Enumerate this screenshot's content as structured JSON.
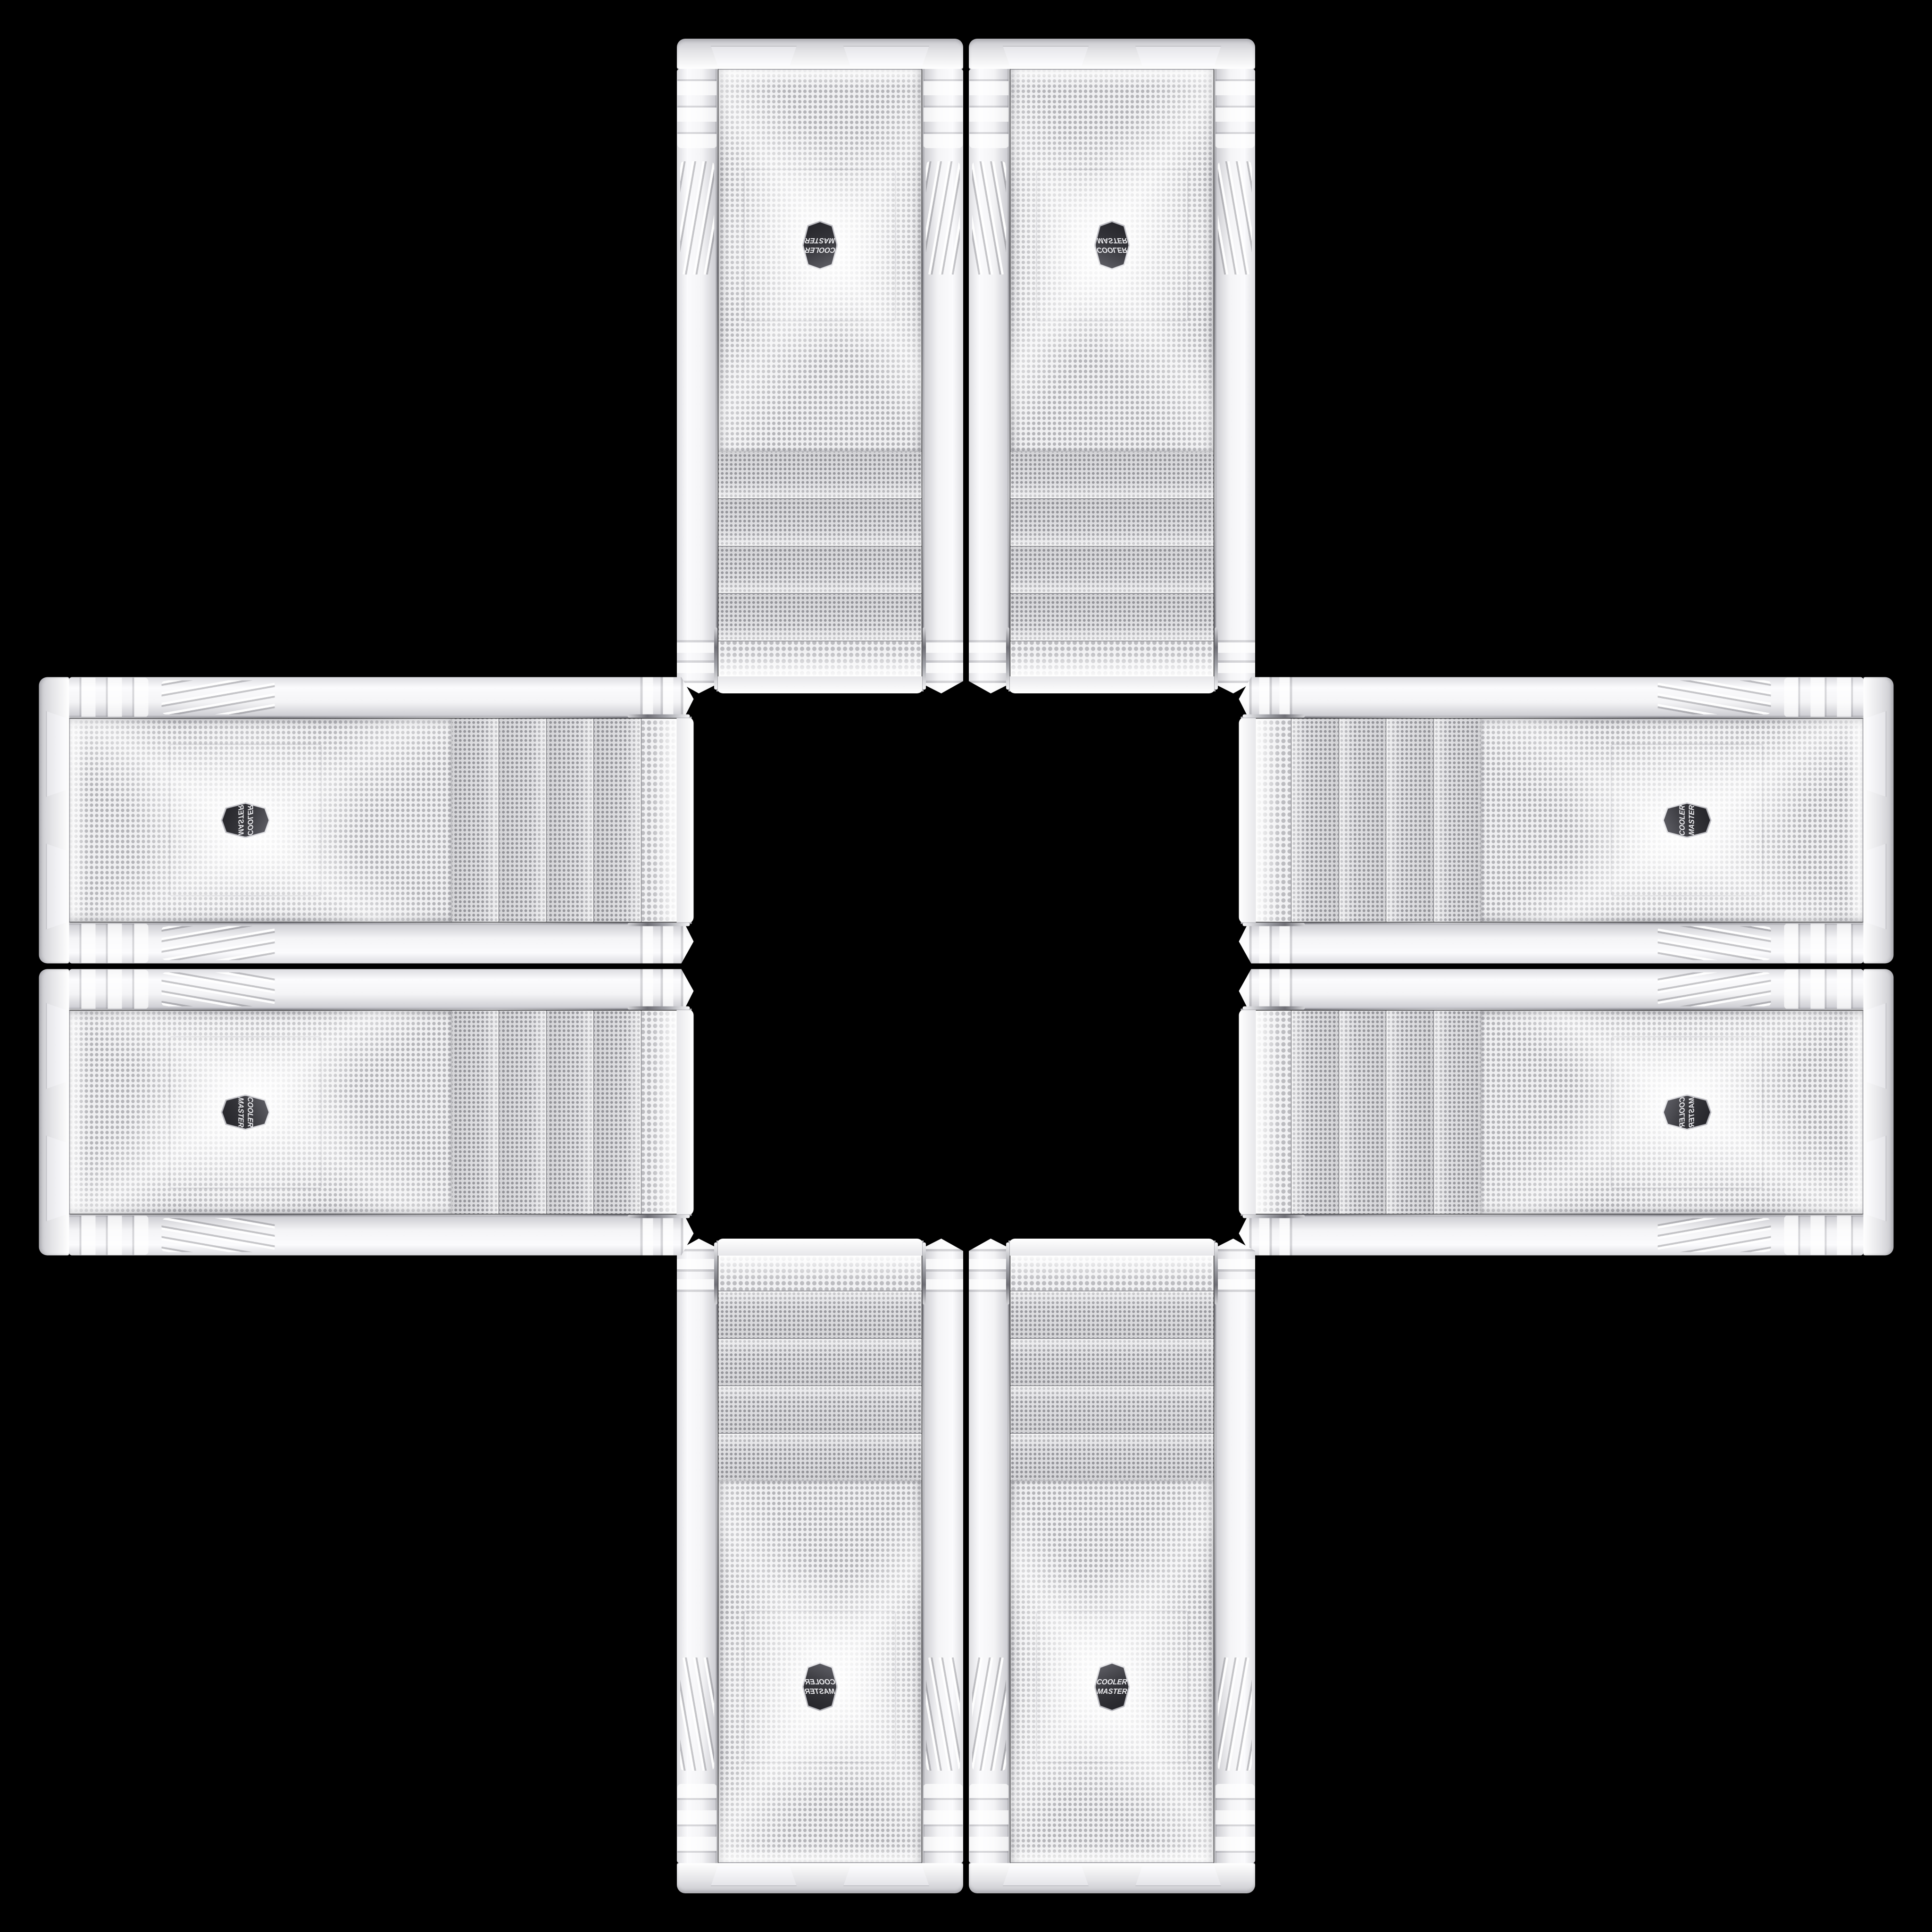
{
  "scene": {
    "description": "Eight identical white Cooler Master PC tower front panels arranged in a plus/cross pattern on a black background; each panel shows a perforated mesh face, four mesh drive-bay covers, ribbed side rails and a dark hexagonal Cooler Master badge near the outer end of each arm",
    "background_color": "#000000",
    "badge": {
      "line1": "COOLER",
      "line2": "MASTER",
      "shape": "hexagon",
      "badge_bg_color": "#35353a",
      "badge_text_color": "#efeff2",
      "badge_rim_color": "#d9d9dc"
    },
    "panel_colors": {
      "frame_highlight": "#fbfbfd",
      "frame_shadow": "#94949a",
      "base_bar": "#e3e3e6",
      "cap_mesh_bg": "#f1f1f3",
      "bay_mesh_bg": "#e0e0e3",
      "bay_dot": "#44444c",
      "fan_mesh_bg": "#efeff1",
      "fan_dot": "#62626a",
      "seam_chrome": "#8d8d94"
    },
    "cases": [
      {
        "id": "top-left",
        "arm": "top",
        "slot": "left",
        "orientation": "vertical",
        "mesh_cap_end": "toward-center",
        "foot_end": "outward",
        "logo_appearance": "rotated-180"
      },
      {
        "id": "top-right",
        "arm": "top",
        "slot": "right",
        "orientation": "vertical",
        "mesh_cap_end": "toward-center",
        "foot_end": "outward",
        "logo_appearance": "flipped-vertical"
      },
      {
        "id": "bottom-left",
        "arm": "bottom",
        "slot": "left",
        "orientation": "vertical",
        "mesh_cap_end": "toward-center",
        "foot_end": "outward",
        "logo_appearance": "mirrored-horizontal"
      },
      {
        "id": "bottom-right",
        "arm": "bottom",
        "slot": "right",
        "orientation": "vertical",
        "mesh_cap_end": "toward-center",
        "foot_end": "outward",
        "logo_appearance": "upright-readable"
      },
      {
        "id": "left-top",
        "arm": "left",
        "slot": "top",
        "orientation": "horizontal",
        "mesh_cap_end": "toward-center",
        "foot_end": "outward",
        "logo_appearance": "rotated-90-mirrored"
      },
      {
        "id": "left-bottom",
        "arm": "left",
        "slot": "bottom",
        "orientation": "horizontal",
        "mesh_cap_end": "toward-center",
        "foot_end": "outward",
        "logo_appearance": "rotated-90-mirrored"
      },
      {
        "id": "right-top",
        "arm": "right",
        "slot": "top",
        "orientation": "horizontal",
        "mesh_cap_end": "toward-center",
        "foot_end": "outward",
        "logo_appearance": "rotated-90-ccw"
      },
      {
        "id": "right-bottom",
        "arm": "right",
        "slot": "bottom",
        "orientation": "horizontal",
        "mesh_cap_end": "toward-center",
        "foot_end": "outward",
        "logo_appearance": "rotated-90-cw"
      }
    ],
    "layout": {
      "arrangement": "plus-cross",
      "panels_per_arm": 2,
      "drive_bay_covers_per_panel": 4,
      "center_gap": "black square"
    }
  }
}
